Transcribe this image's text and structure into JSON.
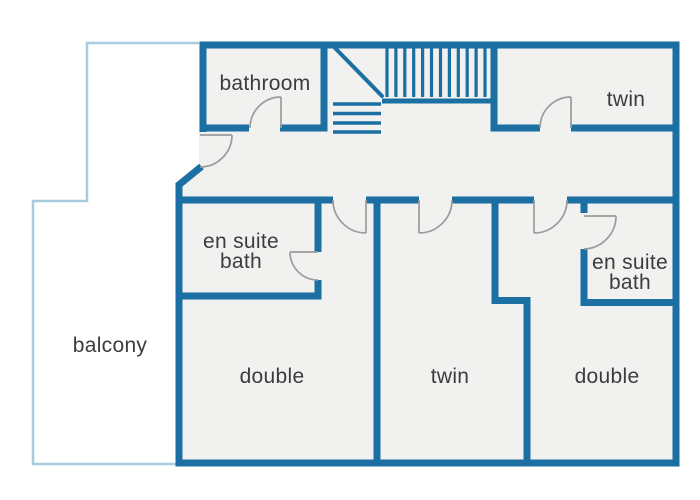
{
  "colors": {
    "wall": "#1B6FA3",
    "balcony": "#A8CBE0",
    "floor": "#F1F1EF",
    "door": "#9B9B9B",
    "label": "#3C3C3C",
    "bg": "#FFFFFF"
  },
  "rooms": [
    {
      "id": "bathroom",
      "label": "bathroom"
    },
    {
      "id": "twin-top",
      "label": "twin"
    },
    {
      "id": "ensuite-left",
      "label_line1": "en suite",
      "label_line2": "bath"
    },
    {
      "id": "ensuite-right",
      "label_line1": "en suite",
      "label_line2": "bath"
    },
    {
      "id": "balcony",
      "label": "balcony"
    },
    {
      "id": "double-left",
      "label": "double"
    },
    {
      "id": "twin-bottom",
      "label": "twin"
    },
    {
      "id": "double-right",
      "label": "double"
    }
  ]
}
